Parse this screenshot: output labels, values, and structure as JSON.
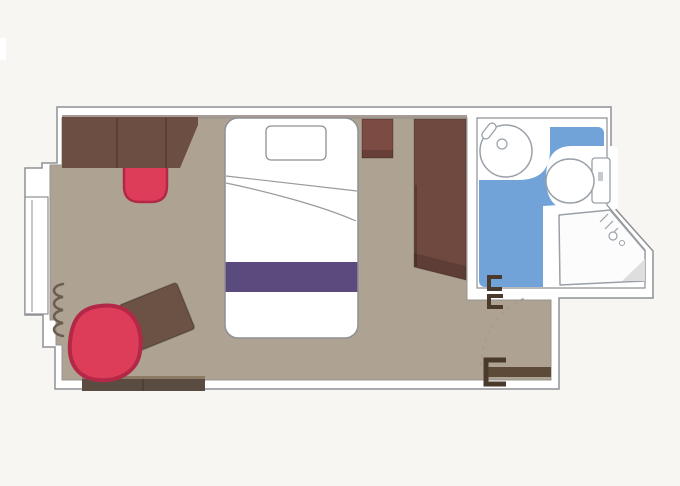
{
  "plan": {
    "kind": "cruise-cabin-floor-plan",
    "rooms": [
      "cabin",
      "bathroom",
      "entry"
    ],
    "items": [
      "balcony-window",
      "curtain",
      "desk-sofa-unit",
      "desk-stool",
      "bed",
      "pillow",
      "bed-runner",
      "blanket-fold",
      "nightstand",
      "wardrobe",
      "armchair",
      "ottoman",
      "luggage-bench",
      "washbasin",
      "faucet",
      "toilet",
      "toilet-tank",
      "shower-tray",
      "shower-head",
      "bathroom-door-handle",
      "entry-door",
      "door-swing-arc"
    ]
  },
  "colors": {
    "background": "#f7f6f3",
    "wall_fill": "#ffffff",
    "wall_line": "#8e9095",
    "floor": "#aea293",
    "top_shadow": "rgba(95,72,60,0.55)",
    "desk": "#6d4e42",
    "seam": "rgba(0,0,0,0.22)",
    "red": "#dd3d58",
    "red_border": "#b32847",
    "purple": "#5a4a7e",
    "nightstand": "#7c4b43",
    "wardrobe": "#6f4940",
    "shade_dark": "rgba(0,0,0,0.16)",
    "ottoman": "#6b5245",
    "bench": "#5a4c41",
    "bench_top": "#8b7a64",
    "curtain": "#6b5d50",
    "fixture_line": "#9aa0a8",
    "blue": "#71a2d8",
    "white": "#ffffff",
    "tray": "#fcfcfc",
    "shade_gray": "#dedede",
    "door_leaf": "#5e4a39",
    "door_handle": "#4a3a2c",
    "arc": "#a39d94",
    "flush_mark": "#c6cad0"
  }
}
